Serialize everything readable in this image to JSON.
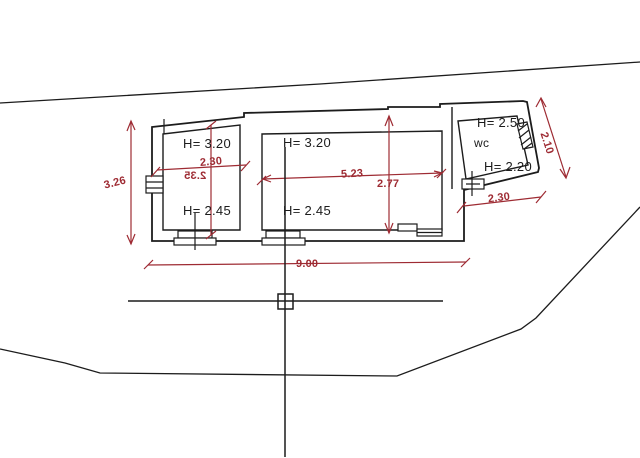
{
  "plan": {
    "left_room": {
      "height_top": "H= 3.20",
      "height_bottom": "H= 2.45",
      "width": "2.30",
      "depth": "2.35"
    },
    "main_room": {
      "height_top": "H= 3.20",
      "height_bottom": "H= 2.45",
      "width": "5.23",
      "depth": "2.77"
    },
    "wc_room": {
      "height_top": "H= 2.50",
      "name": "wc",
      "height_bottom": "H= 2.20",
      "side": "2.10",
      "width": "2.30"
    },
    "overall": {
      "width": "9.00",
      "left_height": "3.26"
    }
  },
  "icons": {
    "cursor": "crosshair-cursor-with-pickbox",
    "windows": "window-symbol",
    "hatch": "hatched-opening"
  },
  "colors": {
    "dimension_red": "#9e2b33",
    "linework_black": "#1c1c1c",
    "background": "#ffffff"
  }
}
